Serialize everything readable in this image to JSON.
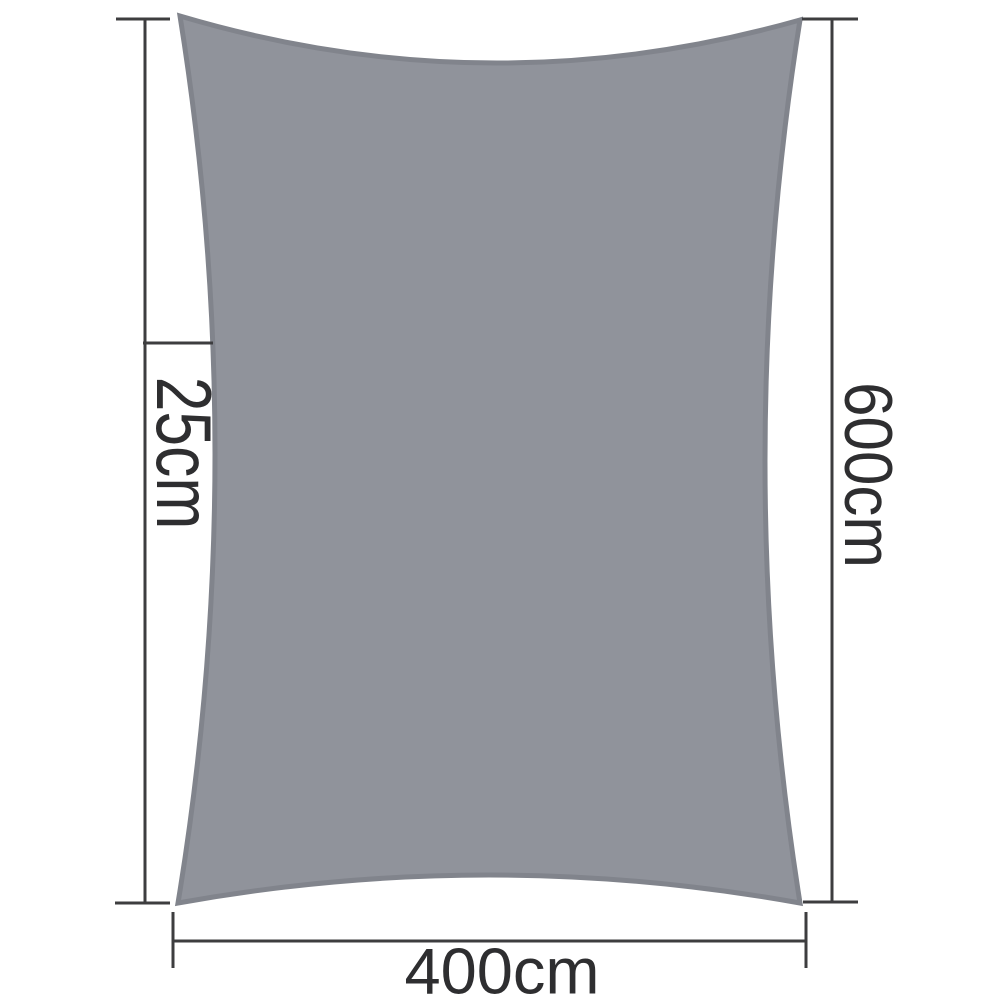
{
  "diagram": {
    "title": "shade sail dimension diagram",
    "shape": "rectangle shade sail with concave edges",
    "labels": {
      "left": "25cm",
      "right": "600cm",
      "bottom": "400cm"
    }
  },
  "colors": {
    "background": "#ffffff",
    "sail_fill": "#90939b",
    "sail_border": "#81848c",
    "dimension_line": "#3d3d3f",
    "label_text": "#2e2e30"
  }
}
